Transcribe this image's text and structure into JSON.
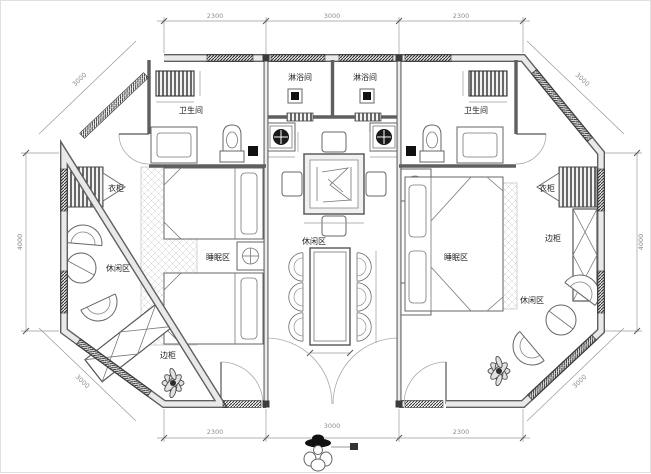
{
  "drawing": {
    "type": "floor-plan",
    "shape": "octagonal"
  },
  "labels": {
    "shower_left": "淋浴间",
    "shower_right": "淋浴间",
    "bath_left": "卫生间",
    "bath_right": "卫生间",
    "wardrobe_left": "衣柜",
    "wardrobe_right": "衣柜",
    "sleep_left": "睡眠区",
    "sleep_right": "睡眠区",
    "leisure_left": "休闲区",
    "leisure_center": "休闲区",
    "leisure_right": "休闲区",
    "cabinet_left": "边柜",
    "cabinet_right": "边柜"
  },
  "dimensions": {
    "top": [
      "2300",
      "3000",
      "2300"
    ],
    "bottom": [
      "2300",
      "3000",
      "2300"
    ],
    "left": "4000",
    "right": "4000",
    "diag_top_left": "3000",
    "diag_top_right": "3000",
    "diag_bottom_left": "3000",
    "diag_bottom_right": "3000",
    "entrance": "3000"
  },
  "colors": {
    "background": "#ffffff",
    "wall_edge": "#5f5f5f",
    "wall_core": "#e9e9e9",
    "hatch_dark": "#2e2e2e",
    "fixture_dark": "#111111",
    "dim_text": "#8d8d8d",
    "label_text": "#1f1f1f"
  }
}
